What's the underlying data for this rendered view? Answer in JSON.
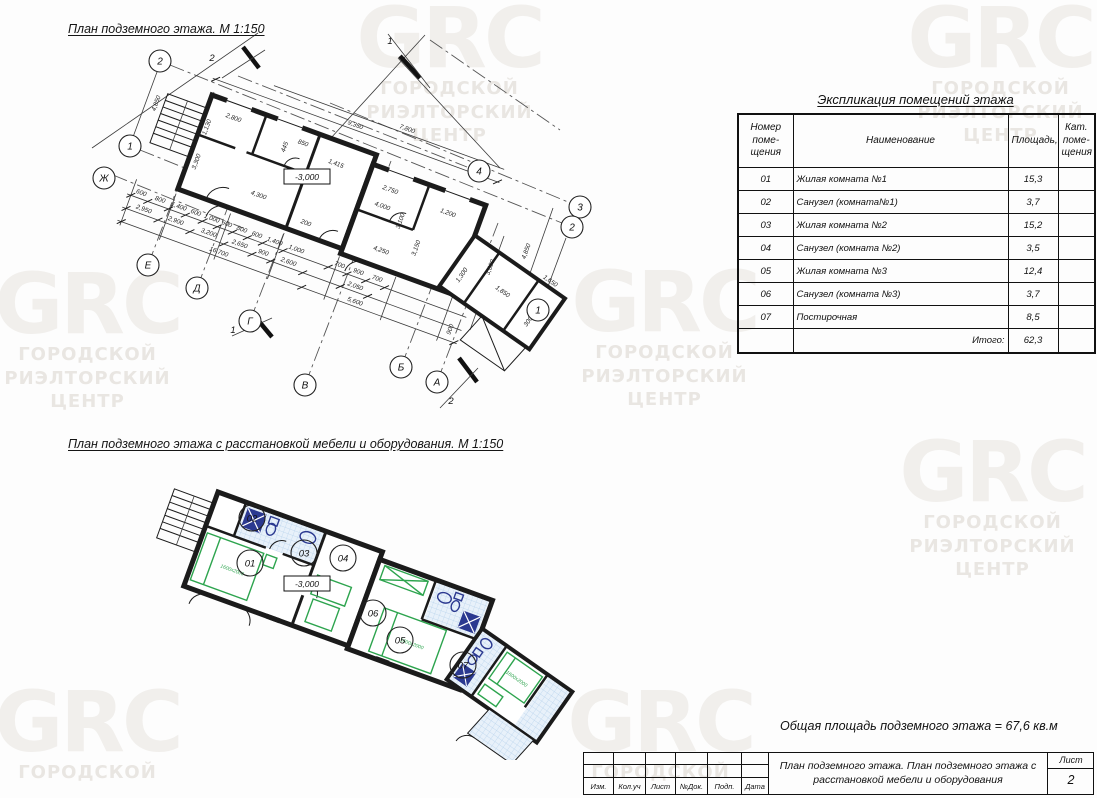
{
  "watermark": {
    "logo": "GRC",
    "lines": [
      "ГОРОДСКОЙ",
      "РИЭЛТОРСКИЙ",
      "ЦЕНТР"
    ]
  },
  "plan1": {
    "title": "План подземного этажа. М 1:150",
    "elevation": "-3,000",
    "bubbles": [
      "2",
      "1",
      "Ж",
      "Е",
      "Д",
      "Г",
      "В",
      "Б",
      "А",
      "4",
      "3",
      "2",
      "1"
    ],
    "sections": [
      "2",
      "1",
      "1",
      "2"
    ],
    "dims": [
      "9,350",
      "7,800",
      "4,850",
      "2,800",
      "1,130",
      "445",
      "850",
      "1,415",
      "2,750",
      "3,300",
      "4,300",
      "200",
      "4,250",
      "3,150",
      "1,200",
      "4,000",
      "3,100",
      "300",
      "1,850",
      "1,300",
      "1,650",
      "3,600",
      "4,850",
      "900",
      "600",
      "800",
      "1,400",
      "600",
      "1,000",
      "600",
      "800",
      "600",
      "1,400",
      "1,000",
      "700",
      "900",
      "700",
      "2,950",
      "2,900",
      "3,200",
      "2,650",
      "900",
      "2,600",
      "2,050",
      "16,700",
      "5,600"
    ]
  },
  "plan2": {
    "title": "План подземного этажа с расстановкой мебели и оборудования. М 1:150",
    "elevation": "-3,000",
    "rooms": [
      "01",
      "02",
      "03",
      "04",
      "05",
      "06",
      "07"
    ],
    "bed_label": "1600x2000"
  },
  "explication": {
    "title": "Экспликация помещений этажа",
    "headers": {
      "col1_lines": [
        "Номер",
        "поме-",
        "щения"
      ],
      "col2": "Наименование",
      "col3": "Площадь,м2",
      "col4_lines": [
        "Кат.",
        "поме-",
        "щения"
      ]
    },
    "rows": [
      {
        "num": "01",
        "name": "Жилая комната №1",
        "area": "15,3",
        "cat": ""
      },
      {
        "num": "02",
        "name": "Санузел (комната№1)",
        "area": "3,7",
        "cat": ""
      },
      {
        "num": "03",
        "name": "Жилая комната №2",
        "area": "15,2",
        "cat": ""
      },
      {
        "num": "04",
        "name": "Санузел (комната №2)",
        "area": "3,5",
        "cat": ""
      },
      {
        "num": "05",
        "name": "Жилая комната №3",
        "area": "12,4",
        "cat": ""
      },
      {
        "num": "06",
        "name": "Санузел (комната №3)",
        "area": "3,7",
        "cat": ""
      },
      {
        "num": "07",
        "name": "Постирочная",
        "area": "8,5",
        "cat": ""
      }
    ],
    "total_label": "Итого:",
    "total_area": "62,3"
  },
  "area_note": "Общая площадь подземного этажа = 67,6 кв.м",
  "titleblock": {
    "stamp_cols": [
      "Изм.",
      "Кол.уч",
      "Лист",
      "№Док.",
      "Подп.",
      "Дата"
    ],
    "doc_title_lines": [
      "План подземного этажа. План подземного этажа с",
      "расстановкой мебели и оборудования"
    ],
    "sheet_label": "Лист",
    "sheet_number": "2"
  },
  "colors": {
    "walls": "#1b1b1b",
    "furniture_green": "#2da44e",
    "sanitary_blue": "#2b3990",
    "hatch_fill": "#e8f1fa",
    "hatch_line": "#b9d3ec",
    "watermark_logo": "#f1efec",
    "watermark_text": "#e9e6e2"
  }
}
